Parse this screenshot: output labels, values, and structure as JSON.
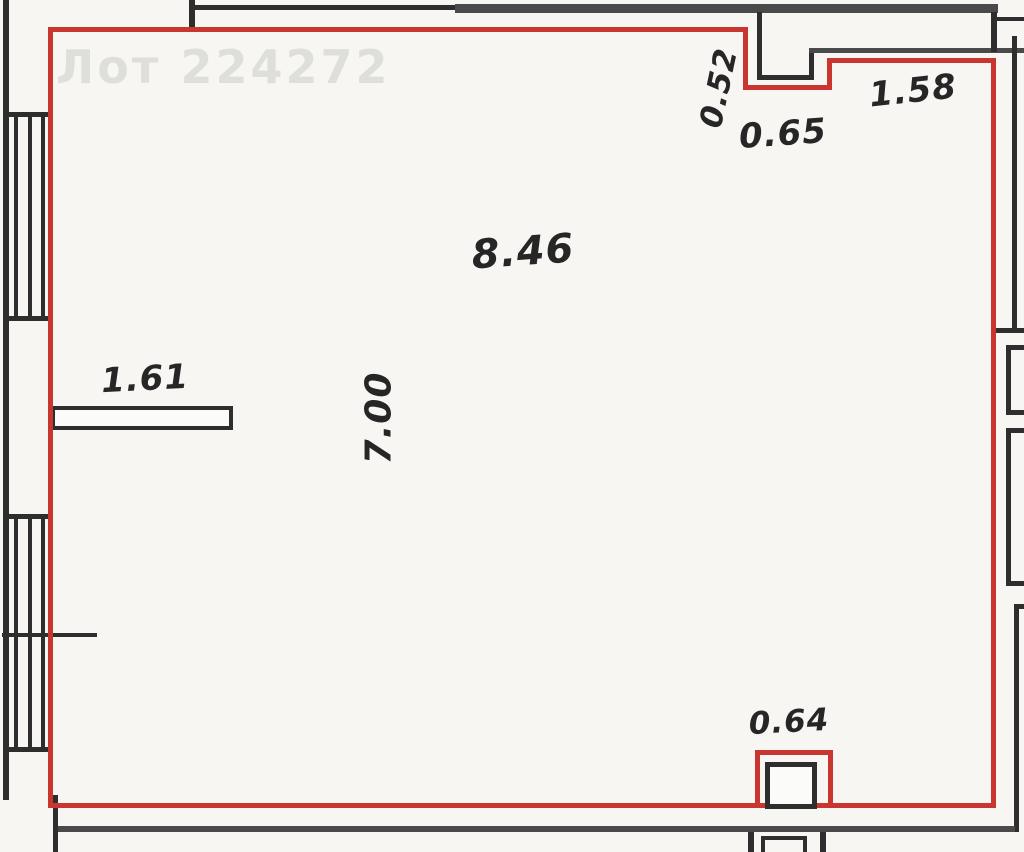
{
  "watermark": {
    "text": "Лот 224272"
  },
  "plan": {
    "room": {
      "area": "8.46"
    },
    "dimensions": {
      "d052": "0.52",
      "d065": "0.65",
      "d158": "1.58",
      "d700": "7.00",
      "d161": "1.61",
      "d064": "0.64"
    },
    "colors": {
      "unit_outline": "#c9362f",
      "walls": "#2e2e2e",
      "secondary_walls": "#4a4a4a"
    }
  }
}
